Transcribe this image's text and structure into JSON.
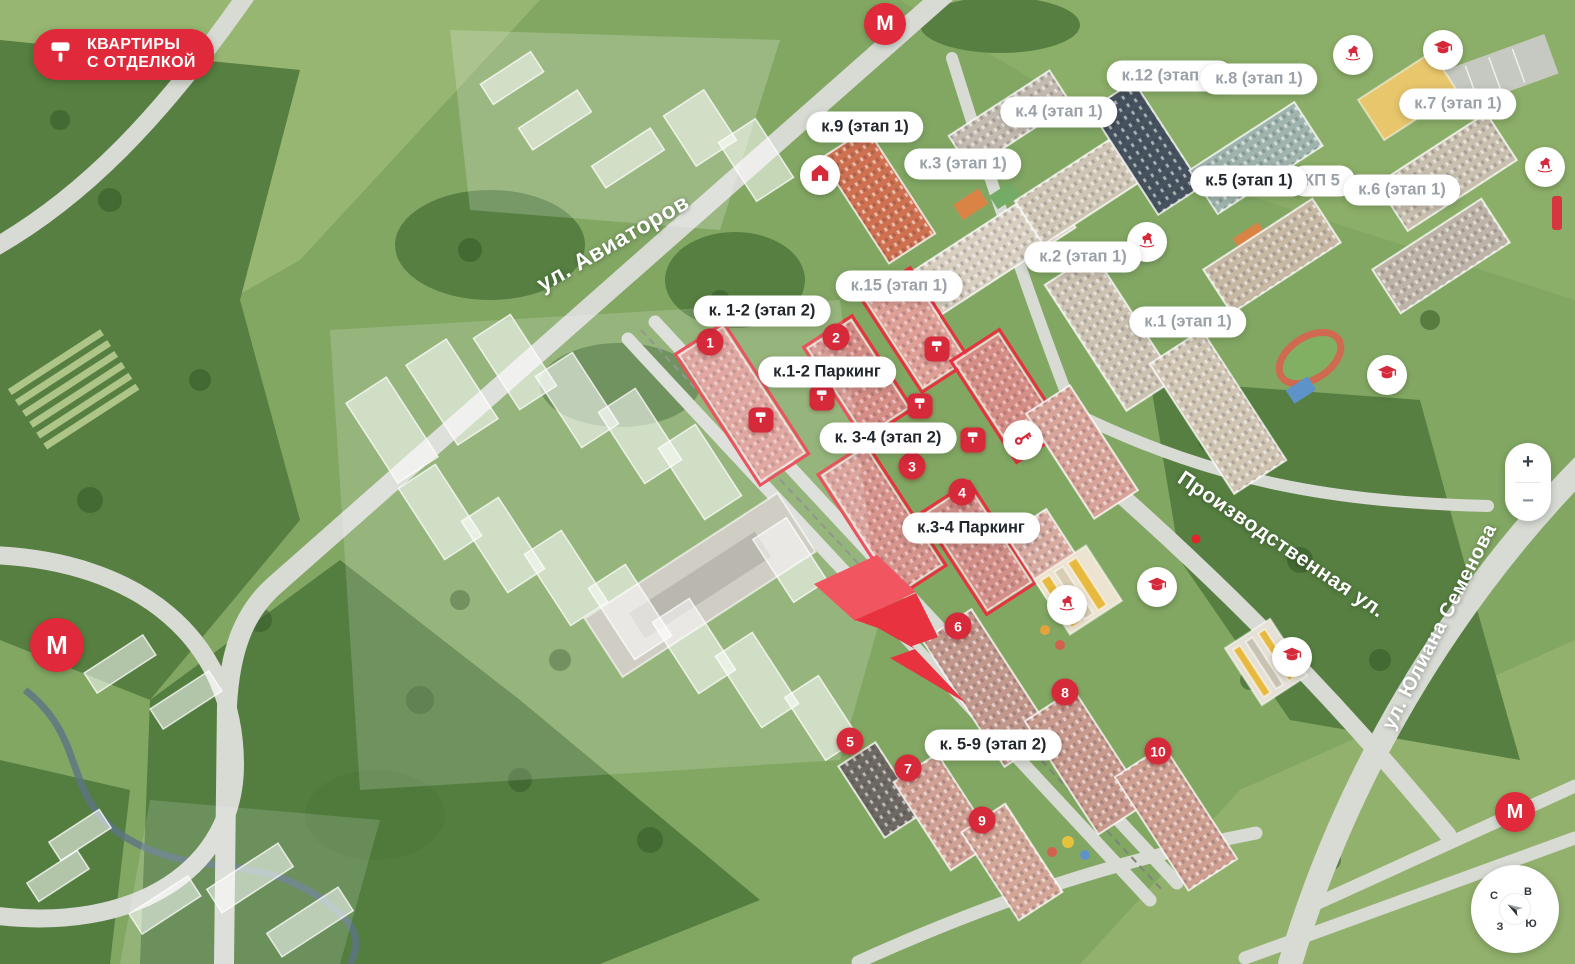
{
  "brand_badge": {
    "line1": "КВАРТИРЫ",
    "line2": "С ОТДЕЛКОЙ",
    "icon": "paint-roller-icon"
  },
  "streets": [
    {
      "name": "ул. Авиаторов"
    },
    {
      "name": "Производственная ул."
    },
    {
      "name": "ул. Юлиана Семенова"
    }
  ],
  "building_labels": [
    {
      "text": "к.9 (этап 1)",
      "state": "active"
    },
    {
      "text": "к.3 (этап 1)",
      "state": "inactive"
    },
    {
      "text": "к.4 (этап 1)",
      "state": "inactive"
    },
    {
      "text": "к.12 (этап 1)",
      "state": "inactive"
    },
    {
      "text": "к.8 (этап 1)",
      "state": "inactive"
    },
    {
      "text": "к.7 (этап 1)",
      "state": "inactive"
    },
    {
      "text": "КП 5",
      "state": "inactive"
    },
    {
      "text": "к.5 (этап 1)",
      "state": "active"
    },
    {
      "text": "к.6 (этап 1)",
      "state": "inactive"
    },
    {
      "text": "к.2 (этап 1)",
      "state": "inactive"
    },
    {
      "text": "к.15 (этап 1)",
      "state": "inactive"
    },
    {
      "text": "к. 1-2 (этап 2)",
      "state": "active"
    },
    {
      "text": "к.1-2 Паркинг",
      "state": "active"
    },
    {
      "text": "к.1 (этап 1)",
      "state": "inactive"
    },
    {
      "text": "к. 3-4 (этап 2)",
      "state": "active"
    },
    {
      "text": "к.3-4 Паркинг",
      "state": "active"
    },
    {
      "text": "к. 5-9 (этап 2)",
      "state": "active"
    }
  ],
  "markers": [
    "1",
    "2",
    "3",
    "4",
    "5",
    "6",
    "7",
    "8",
    "9",
    "10"
  ],
  "amenity_icons": [
    "house",
    "rocking-horse",
    "graduation-cap",
    "rocking-horse",
    "rocking-horse",
    "graduation-cap",
    "key",
    "graduation-cap",
    "rocking-horse",
    "graduation-cap"
  ],
  "metro": {
    "label": "М",
    "count": 3
  },
  "paint_roller_badges": {
    "icon": "paint-roller-icon",
    "count": 5
  },
  "lightning_marker": {
    "icon": "lightning-marker",
    "color": "#e8323f"
  },
  "zoom_controls": {
    "zoom_in": "+",
    "zoom_out": "−"
  },
  "compass": {
    "north": "С",
    "east": "В",
    "west": "З",
    "south": "Ю"
  },
  "colors": {
    "brand_red": "#e0293a",
    "marker_red": "#d6293a",
    "label_active": "#23282e",
    "label_inactive": "#9ba1a8",
    "highlight_outline": "#e8323f"
  }
}
